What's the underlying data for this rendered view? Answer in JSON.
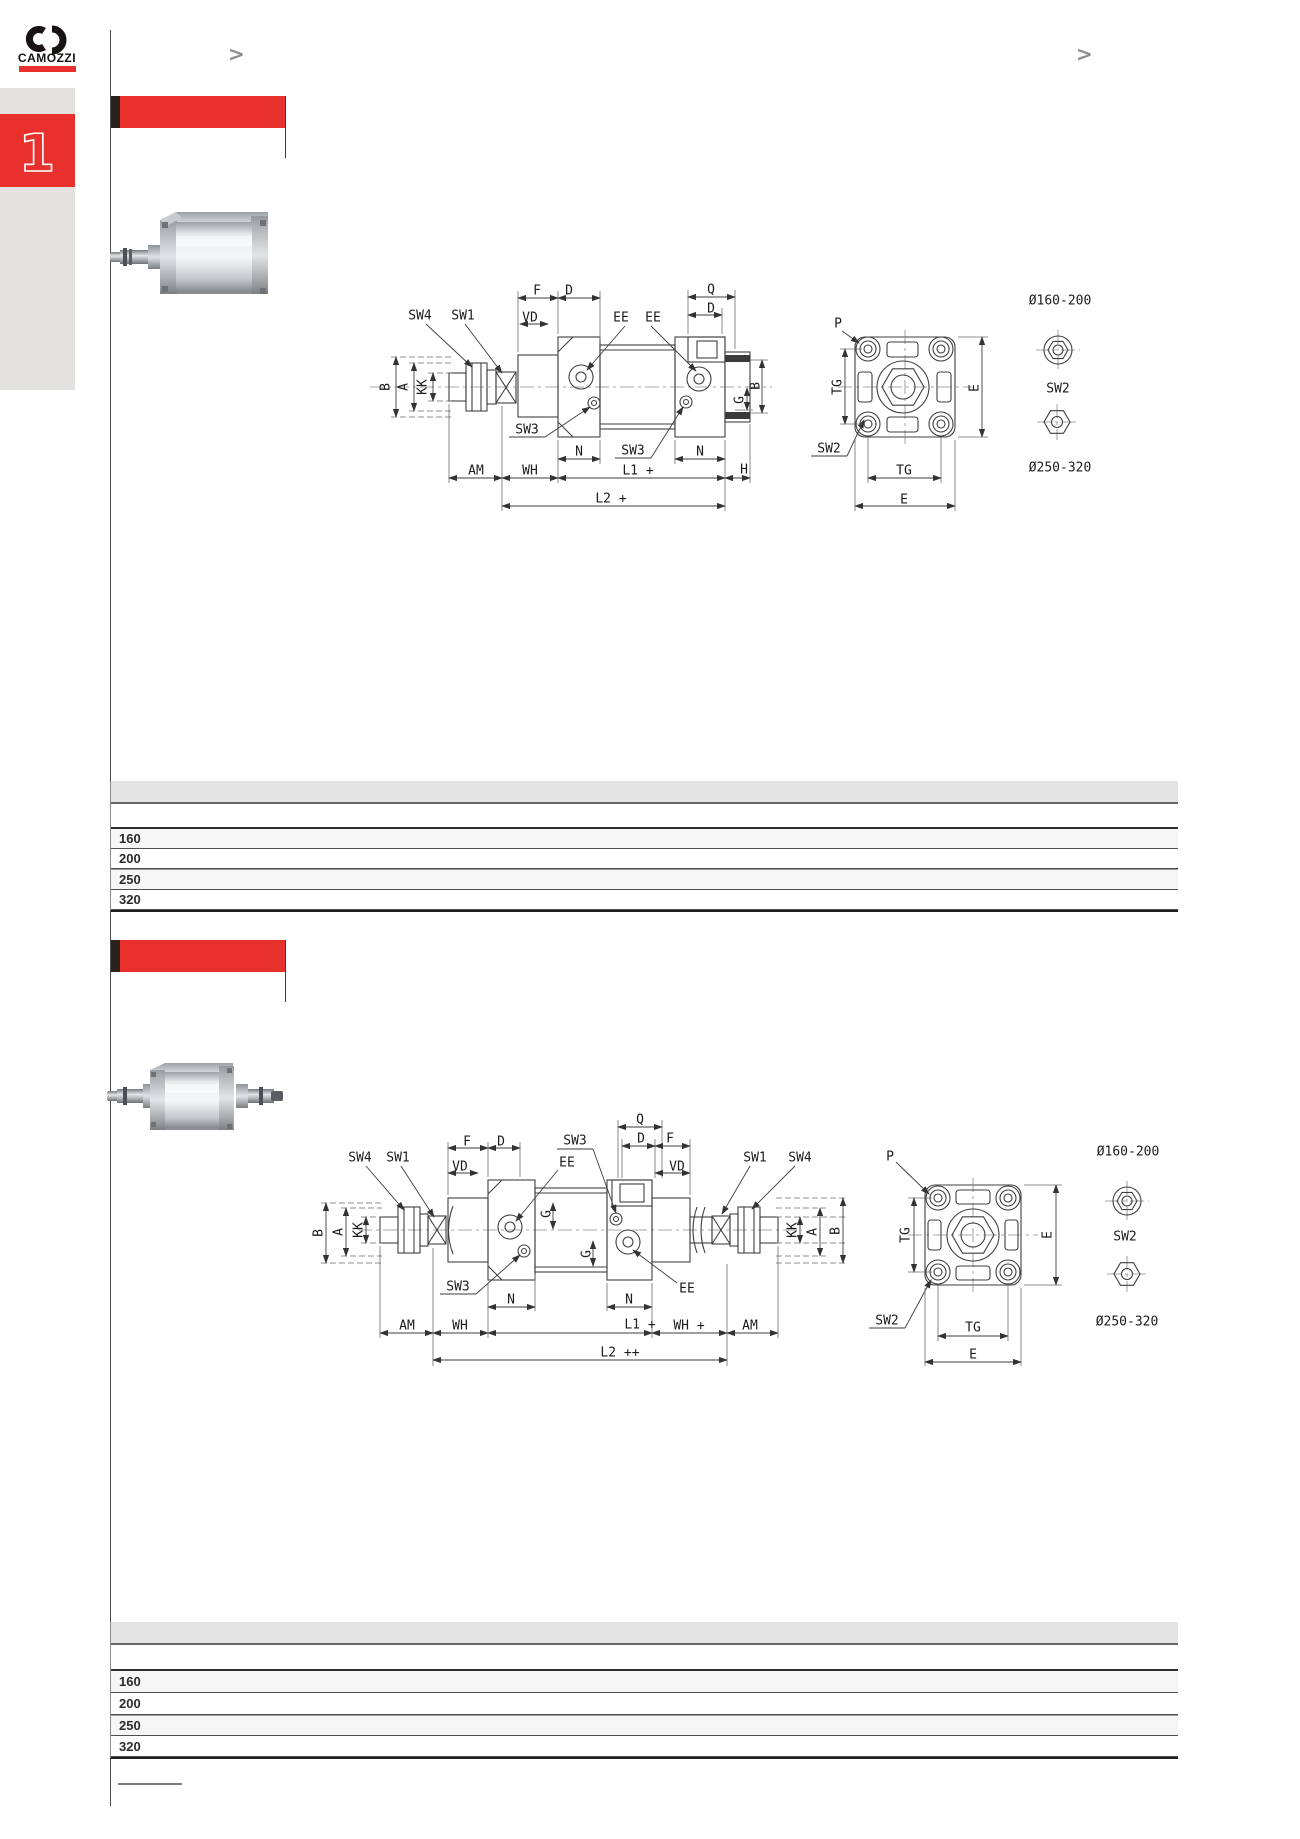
{
  "brand": {
    "name": "CAMOZZI",
    "tab_number": "1"
  },
  "nav": {
    "prev": ">",
    "next": ">"
  },
  "colors": {
    "accent_red": "#e8312d",
    "bar_black": "#2a211c",
    "sidebar_gray": "#e3e2e0",
    "table_header_gray": "#e4e4e4"
  },
  "sections": [
    {
      "drawing": {
        "labels": [
          {
            "t": "SW4",
            "x": 420,
            "y": 316
          },
          {
            "t": "SW1",
            "x": 463,
            "y": 316
          },
          {
            "t": "F",
            "x": 537,
            "y": 291
          },
          {
            "t": "D",
            "x": 569,
            "y": 291
          },
          {
            "t": "VD",
            "x": 530,
            "y": 318
          },
          {
            "t": "EE",
            "x": 621,
            "y": 318
          },
          {
            "t": "EE",
            "x": 653,
            "y": 318
          },
          {
            "t": "Q",
            "x": 711,
            "y": 290
          },
          {
            "t": "D",
            "x": 711,
            "y": 309
          },
          {
            "t": "B",
            "x": 386,
            "y": 387,
            "r": -90
          },
          {
            "t": "A",
            "x": 404,
            "y": 387,
            "r": -90
          },
          {
            "t": "KK",
            "x": 423,
            "y": 387,
            "r": -90
          },
          {
            "t": "G",
            "x": 740,
            "y": 400,
            "r": -90
          },
          {
            "t": "B",
            "x": 756,
            "y": 386,
            "r": -90
          },
          {
            "t": "SW3",
            "x": 527,
            "y": 430
          },
          {
            "t": "SW3",
            "x": 633,
            "y": 451
          },
          {
            "t": "N",
            "x": 579,
            "y": 452
          },
          {
            "t": "N",
            "x": 700,
            "y": 452
          },
          {
            "t": "AM",
            "x": 476,
            "y": 471
          },
          {
            "t": "WH",
            "x": 530,
            "y": 471
          },
          {
            "t": "L1 +",
            "x": 638,
            "y": 471
          },
          {
            "t": "H",
            "x": 744,
            "y": 470
          },
          {
            "t": "L2 +",
            "x": 611,
            "y": 499
          },
          {
            "t": "P",
            "x": 838,
            "y": 324
          },
          {
            "t": "TG",
            "x": 838,
            "y": 387,
            "r": -90
          },
          {
            "t": "E",
            "x": 975,
            "y": 388,
            "r": -90
          },
          {
            "t": "SW2",
            "x": 829,
            "y": 449
          },
          {
            "t": "TG",
            "x": 904,
            "y": 471
          },
          {
            "t": "E",
            "x": 904,
            "y": 500
          },
          {
            "t": "Ø160-200",
            "x": 1060,
            "y": 301
          },
          {
            "t": "SW2",
            "x": 1058,
            "y": 389
          },
          {
            "t": "Ø250-320",
            "x": 1060,
            "y": 468
          }
        ]
      },
      "table": {
        "rows": [
          "160",
          "200",
          "250",
          "320"
        ]
      }
    },
    {
      "drawing": {
        "labels": [
          {
            "t": "SW4",
            "x": 360,
            "y": 1158
          },
          {
            "t": "SW1",
            "x": 398,
            "y": 1158
          },
          {
            "t": "F",
            "x": 467,
            "y": 1142
          },
          {
            "t": "D",
            "x": 501,
            "y": 1142
          },
          {
            "t": "VD",
            "x": 460,
            "y": 1167
          },
          {
            "t": "SW3",
            "x": 575,
            "y": 1141
          },
          {
            "t": "EE",
            "x": 567,
            "y": 1163
          },
          {
            "t": "Q",
            "x": 640,
            "y": 1120
          },
          {
            "t": "D",
            "x": 641,
            "y": 1139
          },
          {
            "t": "F",
            "x": 670,
            "y": 1139
          },
          {
            "t": "VD",
            "x": 677,
            "y": 1167
          },
          {
            "t": "SW1",
            "x": 755,
            "y": 1158
          },
          {
            "t": "SW4",
            "x": 800,
            "y": 1158
          },
          {
            "t": "B",
            "x": 319,
            "y": 1233,
            "r": -90
          },
          {
            "t": "A",
            "x": 339,
            "y": 1232,
            "r": -90
          },
          {
            "t": "KK",
            "x": 359,
            "y": 1230,
            "r": -90
          },
          {
            "t": "KK",
            "x": 793,
            "y": 1230,
            "r": -90
          },
          {
            "t": "A",
            "x": 813,
            "y": 1232,
            "r": -90
          },
          {
            "t": "B",
            "x": 836,
            "y": 1231,
            "r": -90
          },
          {
            "t": "G",
            "x": 547,
            "y": 1214,
            "r": -90
          },
          {
            "t": "G",
            "x": 587,
            "y": 1254,
            "r": -90
          },
          {
            "t": "SW3",
            "x": 458,
            "y": 1287
          },
          {
            "t": "EE",
            "x": 687,
            "y": 1289
          },
          {
            "t": "N",
            "x": 511,
            "y": 1300
          },
          {
            "t": "N",
            "x": 629,
            "y": 1300
          },
          {
            "t": "AM",
            "x": 407,
            "y": 1326
          },
          {
            "t": "WH",
            "x": 460,
            "y": 1326
          },
          {
            "t": "L1 +",
            "x": 640,
            "y": 1325
          },
          {
            "t": "WH +",
            "x": 689,
            "y": 1326
          },
          {
            "t": "AM",
            "x": 750,
            "y": 1326
          },
          {
            "t": "L2 ++",
            "x": 620,
            "y": 1353
          },
          {
            "t": "P",
            "x": 890,
            "y": 1157
          },
          {
            "t": "TG",
            "x": 906,
            "y": 1235,
            "r": -90
          },
          {
            "t": "E",
            "x": 1048,
            "y": 1235,
            "r": -90
          },
          {
            "t": "SW2",
            "x": 887,
            "y": 1321
          },
          {
            "t": "TG",
            "x": 973,
            "y": 1328
          },
          {
            "t": "E",
            "x": 973,
            "y": 1355
          },
          {
            "t": "Ø160-200",
            "x": 1128,
            "y": 1152
          },
          {
            "t": "SW2",
            "x": 1125,
            "y": 1237
          },
          {
            "t": "Ø250-320",
            "x": 1127,
            "y": 1322
          }
        ]
      },
      "table": {
        "rows": [
          "160",
          "200",
          "250",
          "320"
        ]
      }
    }
  ]
}
